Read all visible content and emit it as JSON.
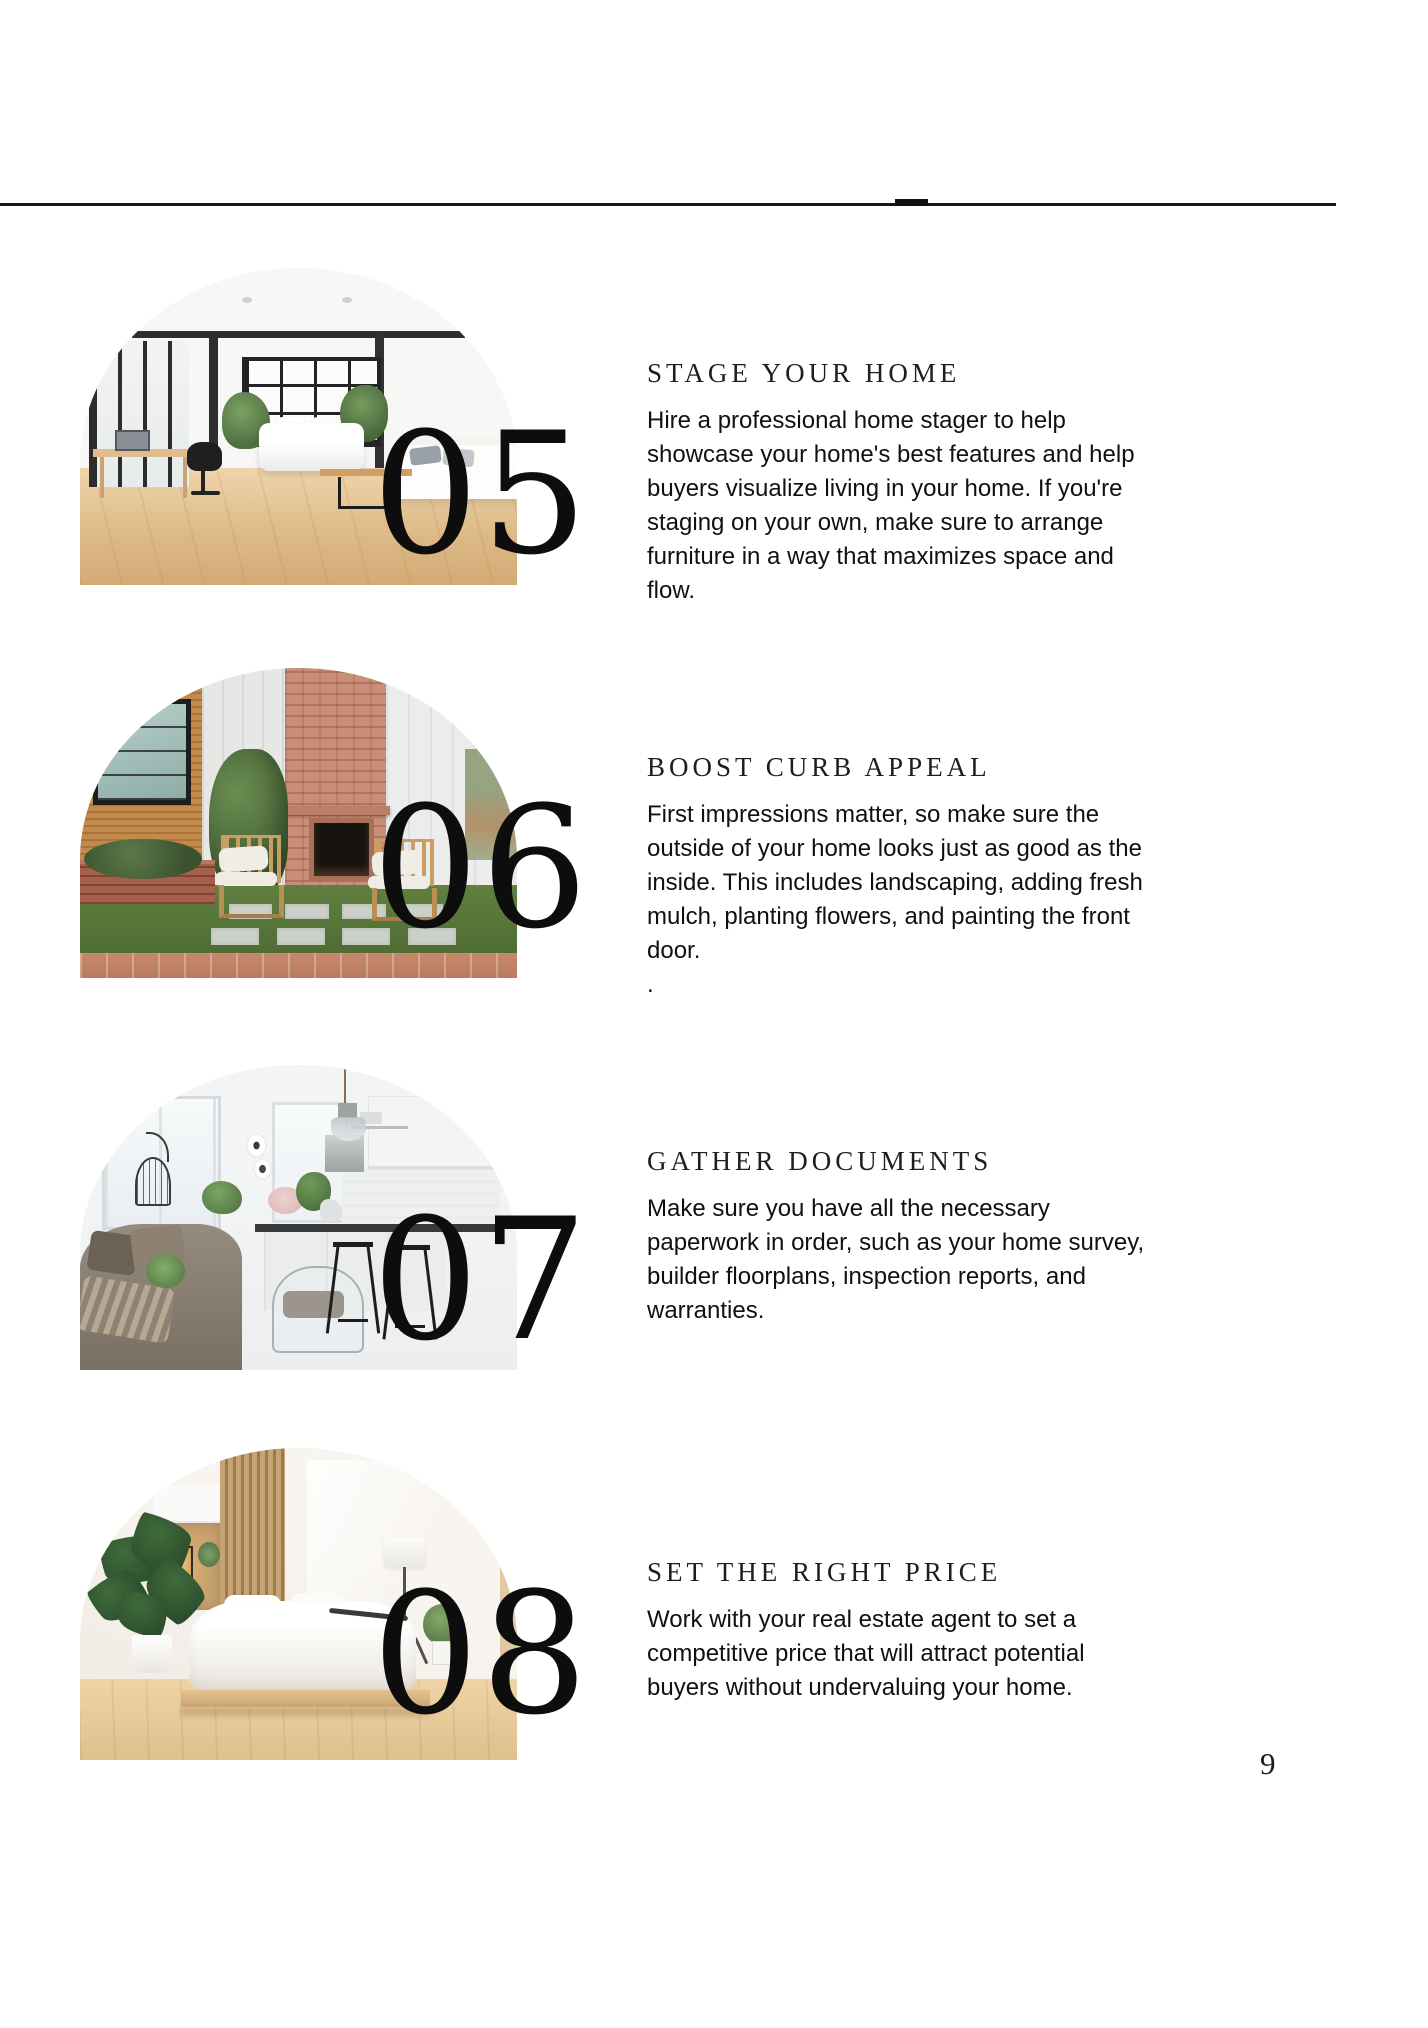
{
  "page": {
    "number": "9",
    "ink_color": "#161616",
    "text_color": "#101010"
  },
  "sections": [
    {
      "number": "05",
      "title": "STAGE YOUR HOME",
      "body": "Hire a professional home stager to help\nshowcase your home's best features and help\nbuyers visualize living in your home. If you're\nstaging on your own, make sure to arrange\nfurniture in a way that maximizes space and\nflow.",
      "photo": "loft-living-room"
    },
    {
      "number": "06",
      "title": "BOOST CURB APPEAL",
      "body": "First impressions matter, so make sure the\noutside of your home looks just as good as the\ninside. This includes landscaping, adding fresh\nmulch, planting flowers, and painting the front\ndoor.\n.",
      "photo": "backyard-brick-fireplace"
    },
    {
      "number": "07",
      "title": "GATHER DOCUMENTS",
      "body": "Make sure you have all the necessary\npaperwork in order, such as your home survey,\nbuilder floorplans, inspection reports, and\nwarranties.",
      "photo": "white-kitchen-interior"
    },
    {
      "number": "08",
      "title": "SET THE RIGHT PRICE",
      "body": "Work with your real estate agent to set a\ncompetitive price that will attract potential\nbuyers without undervaluing your home.",
      "photo": "japandi-bedroom"
    }
  ]
}
